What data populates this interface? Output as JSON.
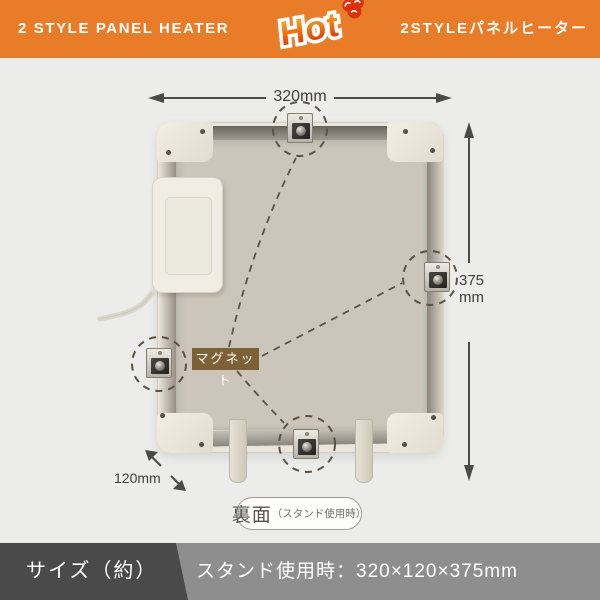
{
  "header": {
    "title_en": "2 STYLE PANEL HEATER",
    "logo_text": "Hot",
    "title_jp": "2STYLEパネルヒーター",
    "bg_color": "#E87C28"
  },
  "diagram": {
    "width_label": "320mm",
    "height_value": "375",
    "height_unit": "mm",
    "depth_label": "120mm",
    "magnet_label": "マグネット",
    "caption_main": "裏面",
    "caption_sub": "（スタンド使用時）",
    "magnet_tag_color": "#7D6136",
    "dashed_line_color": "#5B5144",
    "arrow_color": "#4A4A4A"
  },
  "footer": {
    "left_label": "サイズ（約）",
    "right_label": "スタンド使用時：320×120×375mm",
    "dark_color": "#4A4A4A",
    "light_color": "#8E8E8E"
  }
}
